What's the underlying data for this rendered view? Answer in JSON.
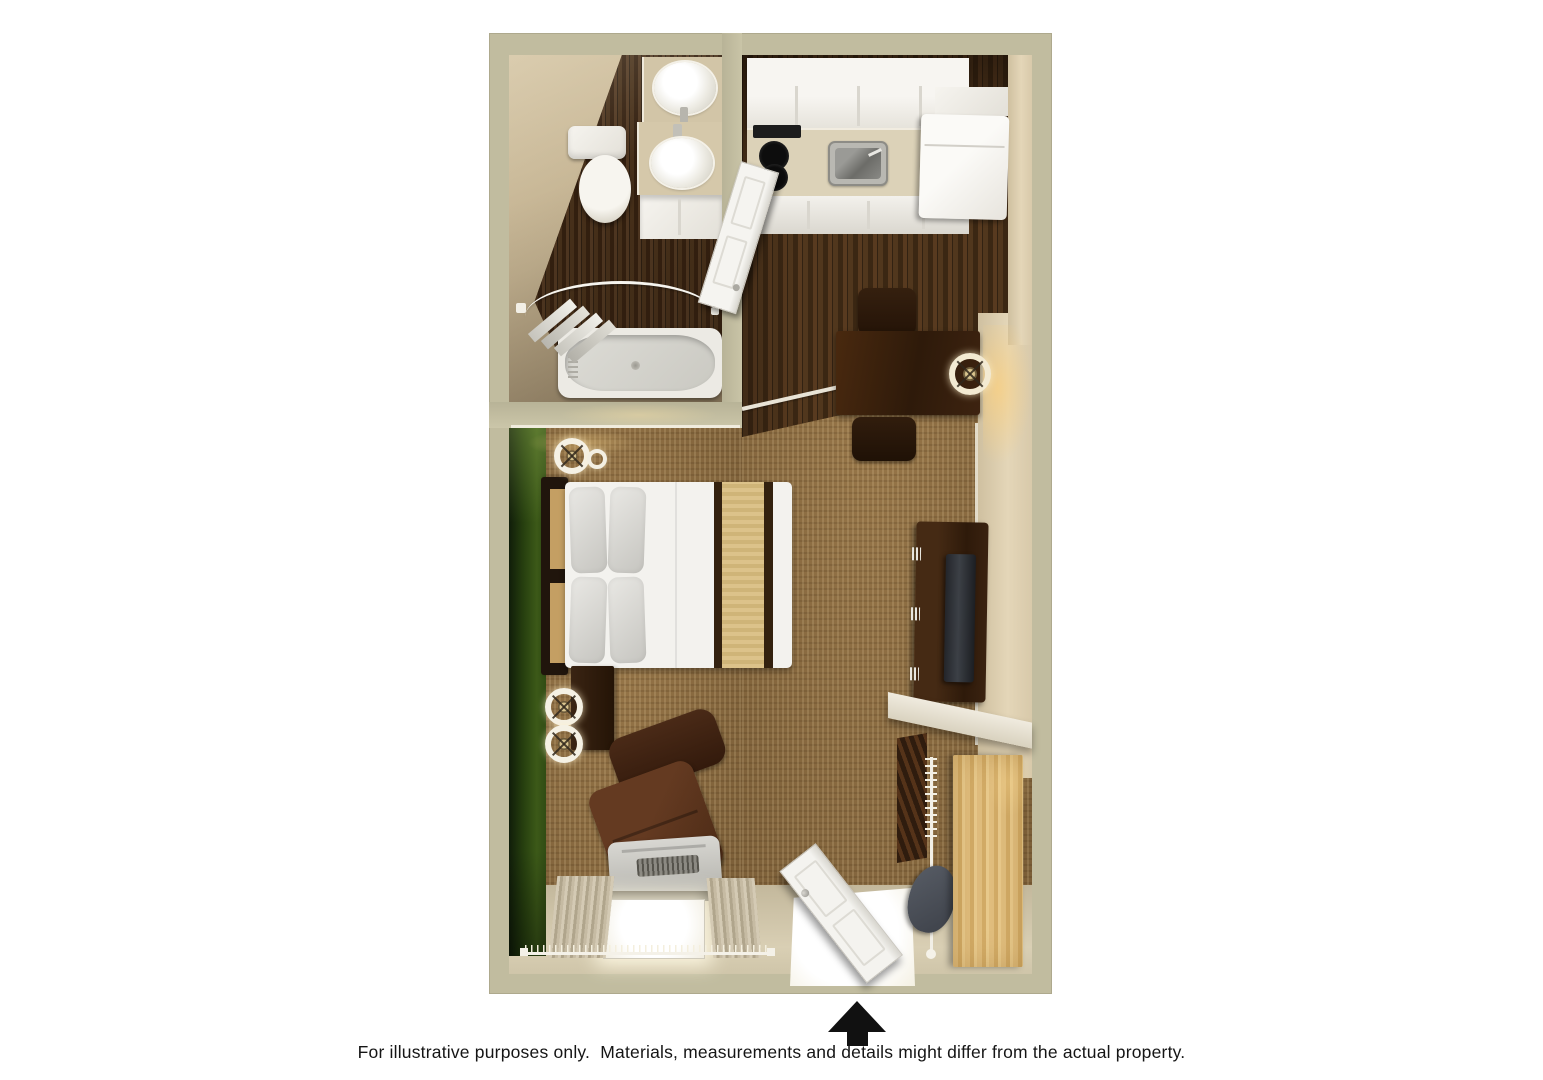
{
  "caption": {
    "text": "For illustrative purposes only.  Materials, measurements and details might differ from the actual property."
  },
  "entrance_arrow": {
    "meaning": "entrance",
    "direction": "up",
    "color": "#111111"
  },
  "palette": {
    "outer_wall": "#c1bc9f",
    "inner_wall_face": "#d8caab",
    "accent_wall_green": "#33491a",
    "carpet": "#8d6c40",
    "wood_floor": "#46301a",
    "bathroom_wood": "#3b2817",
    "floor_transition": "#e8e3d6",
    "bed_linen": "#f3f2ee",
    "bed_runner_tan": "#d6ba82",
    "runner_stripe": "#33210f",
    "dark_wood_furniture": "#3a2312",
    "leather_chair": "#56321d",
    "desk_wood": "#d9b678",
    "fixture_white": "#f2f0ea",
    "appliance_white": "#f4f2ee",
    "countertop": "#dcd2b8",
    "stainless_steel": "#8f8f8b",
    "cooktop_black": "#1c1c1c",
    "arrow_black": "#111111",
    "caption_text": "#151515"
  },
  "rooms": {
    "bathroom": {
      "fixtures": [
        "toilet",
        "vanity-with-two-sinks",
        "bathtub",
        "curved-shower-rod",
        "towels"
      ]
    },
    "kitchen": {
      "fixtures": [
        "upper-cabinets",
        "two-burner-cooktop",
        "kitchen-sink",
        "base-cabinets",
        "refrigerator",
        "open-bathroom-door"
      ]
    },
    "main_room": {
      "fixtures": [
        "bed",
        "headboard",
        "nightstand",
        "bedside-lamps",
        "recliner-armchair",
        "ac-unit",
        "window-with-curtains",
        "dining-table",
        "two-dining-chairs",
        "table-lamp",
        "tv-console",
        "tv",
        "closet-shelf",
        "closet-rod",
        "hanging-clothes",
        "desk",
        "desk-chair",
        "entry-door"
      ]
    }
  }
}
